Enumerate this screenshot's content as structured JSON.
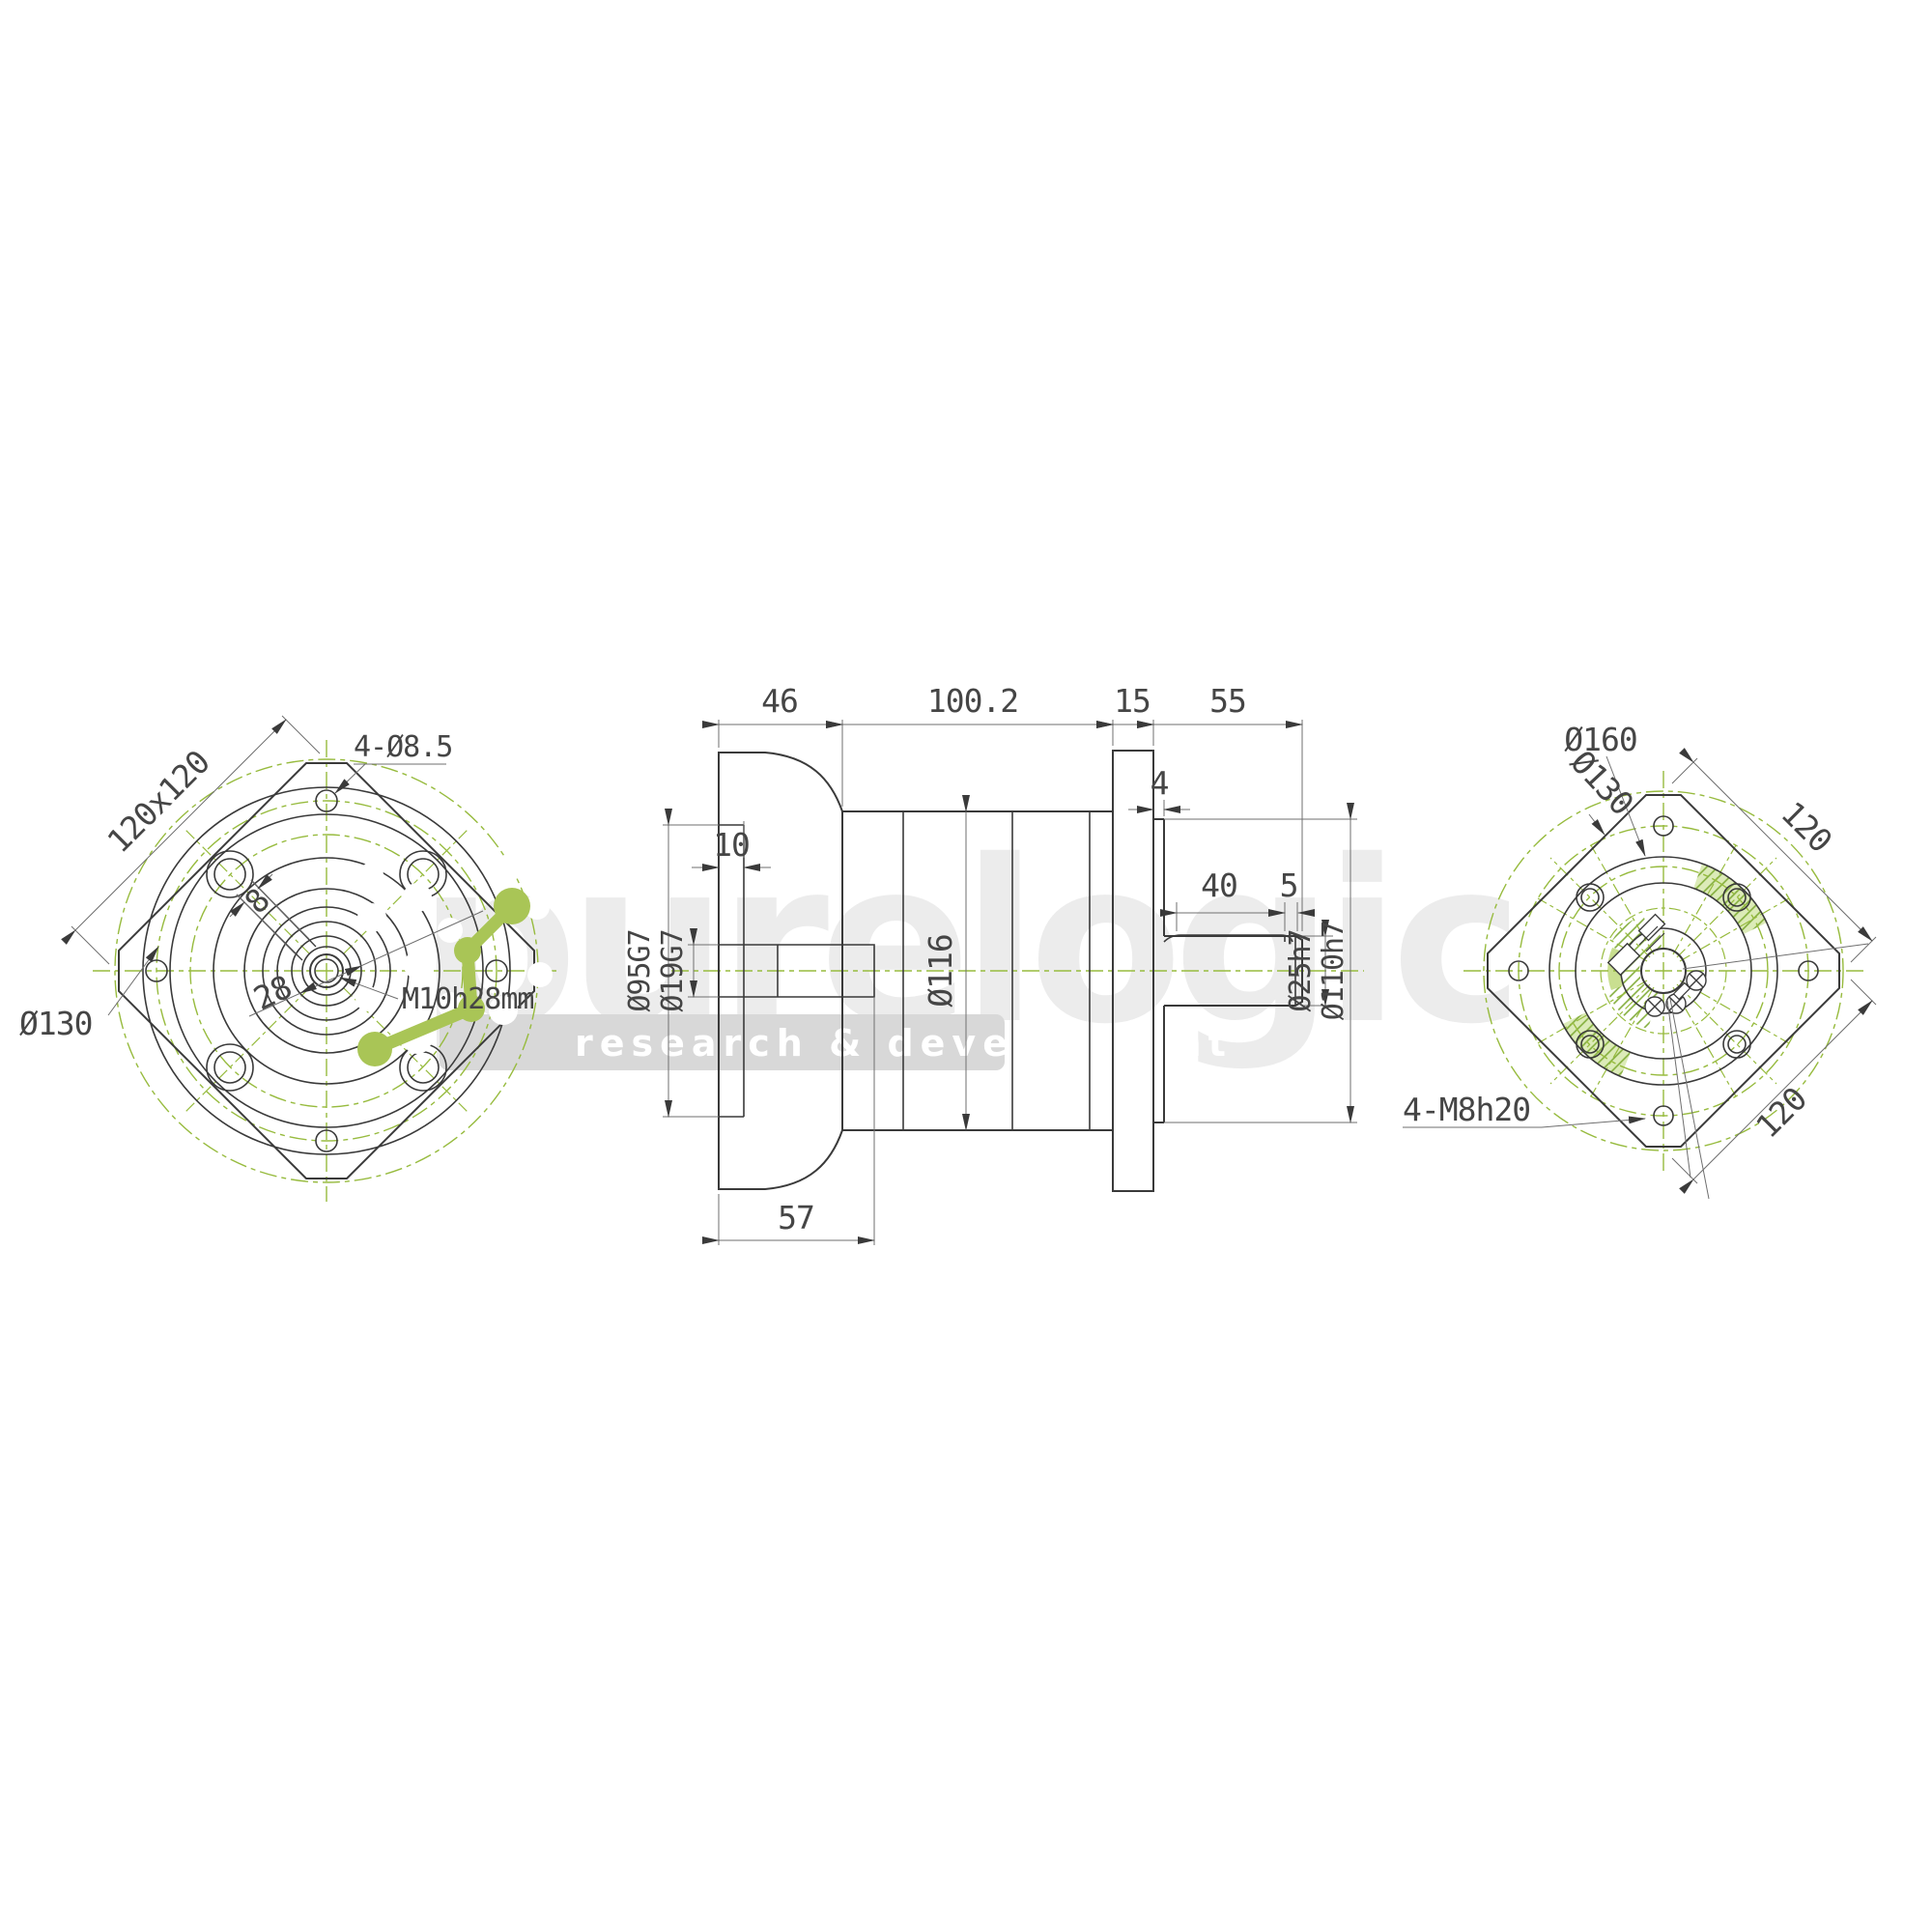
{
  "watermark": {
    "brand": "purelogic",
    "tagline": "research & development",
    "brand_color": "#ececec",
    "band_color": "#d8d8d8",
    "logo_green": "#a9c556"
  },
  "drawing_colors": {
    "line_dark": "#3a3a3a",
    "dim_line": "#6f6f6f",
    "centerline_green": "#97bb3e",
    "hatch_green": "#82ad3a",
    "fill_light_green": "#d6e7a8"
  },
  "views": {
    "front": {
      "size_label": "120x120",
      "corner_holes": "4-Ø8.5",
      "bolt_circle": "Ø130",
      "keyway_width": "8",
      "hub_dia": "28",
      "thread_note": "M10h28mm"
    },
    "side": {
      "len_input": "46",
      "len_body": "100.2",
      "len_flange": "15",
      "len_shaft": "55",
      "pilot_len": "4",
      "recess_depth": "10",
      "keyway_len": "40",
      "keyway_end_gap": "5",
      "bore_depth": "57",
      "dia_body": "Ø116",
      "dia_recess": "Ø95G7",
      "dia_bore": "Ø19G7",
      "dia_shaft": "Ø25h7",
      "dia_pilot": "Ø110h7"
    },
    "rear": {
      "dia_flange": "Ø160",
      "bolt_circle": "Ø130",
      "square_w": "120",
      "square_h": "120",
      "tapped_holes": "4-M8h20"
    }
  }
}
